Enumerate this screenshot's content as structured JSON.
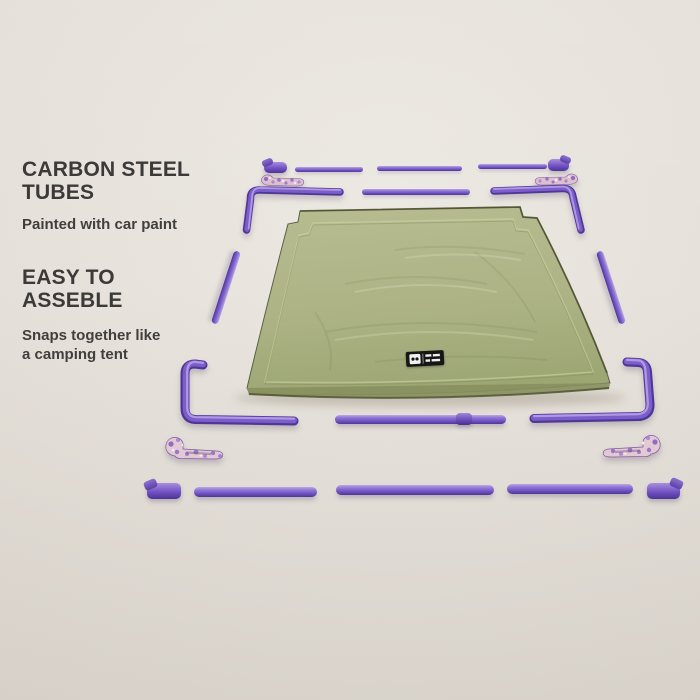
{
  "page": {
    "background_color": "#e5e0d9"
  },
  "info_panel": {
    "text_color": "#3b3a38",
    "section_tubes": {
      "heading_line1": "CARBON STEEL",
      "heading_line2": "TUBES",
      "body": "Painted with car paint"
    },
    "section_assembly": {
      "heading_line1": "EASY TO",
      "heading_line2": "ASSEBLE",
      "body_line1": "Snaps together like",
      "body_line2": "a camping tent"
    }
  },
  "scene": {
    "product": "exploded parts view of an elevated pet cot",
    "colors": {
      "tube_purple": "#7c5ecb",
      "tube_highlight": "#b6a0e4",
      "tube_shadow": "#4f3796",
      "fabric_green": "#adb385",
      "fabric_trim": "#4c5331",
      "foot_marble": "#ddbfce",
      "label_background": "#161616"
    },
    "parts": {
      "fabric_cover": "quilted cot cover",
      "frame_tubes": "straight frame tubes",
      "corner_tubes": "bent corner tubes",
      "snap_clips": "snap-on end clips",
      "feet": "marbled rubber feet",
      "brand_label": "black woven brand tag"
    }
  }
}
